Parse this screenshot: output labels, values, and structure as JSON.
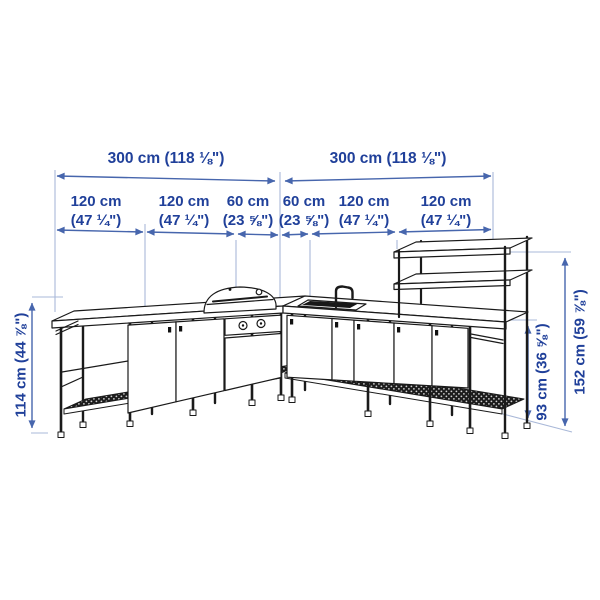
{
  "diagram_title": "L-shaped outdoor kitchen dimension diagram",
  "colors": {
    "dimension_text": "#20409a",
    "dimension_line": "#4766ad",
    "extension_line": "#a9b8d8",
    "drawing_line": "#1a1a1a",
    "background": "#ffffff"
  },
  "dimensions": {
    "top_row": [
      {
        "label": "300 cm (118 ⅛\")"
      },
      {
        "label": "300 cm (118 ⅛\")"
      }
    ],
    "width_segments": [
      {
        "cm": "120 cm",
        "inches": "(47 ¼\")"
      },
      {
        "cm": "120 cm",
        "inches": "(47 ¼\")"
      },
      {
        "cm": "60 cm",
        "inches": "(23 ⅝\")"
      },
      {
        "cm": "60 cm",
        "inches": "(23 ⅝\")"
      },
      {
        "cm": "120 cm",
        "inches": "(47 ¼\")"
      },
      {
        "cm": "120 cm",
        "inches": "(47 ¼\")"
      }
    ],
    "heights": {
      "left": "114 cm (44 ⅞\")",
      "right_counter": "93 cm (36 ⅝\")",
      "right_total": "152 cm (59 ⅞\")"
    }
  },
  "illustration": {
    "type": "black line drawing, perspective view into inside corner",
    "subject": "L-shaped outdoor kitchen frame with cabinets",
    "parts": [
      "left cabinet run with doors and open end module",
      "dome charcoal grill with two control knobs",
      "right cabinet run with doors",
      "sink with gooseneck faucet",
      "tall shelf unit with two shelves at right end",
      "mesh bottom shelves",
      "frame legs with feet"
    ]
  }
}
